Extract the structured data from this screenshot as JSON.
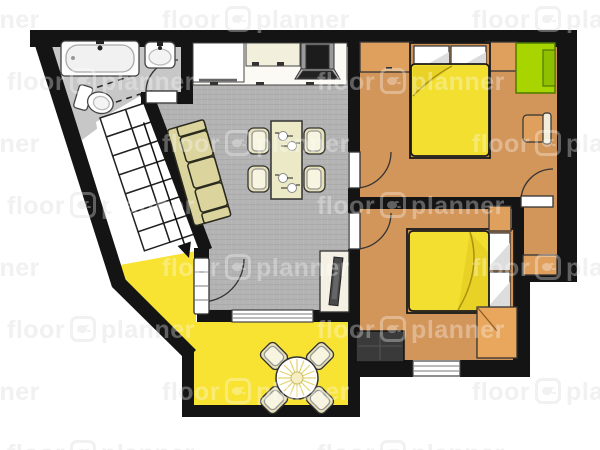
{
  "app": {
    "brand": "floorplanner"
  },
  "watermark": {
    "word_left": "floor",
    "word_right": "planner",
    "logo": "floorplanner-paw-logo",
    "rows": 8,
    "tiles_per_row": 3,
    "row_spacing_px": 62,
    "tile_period_px": 310,
    "even_row_offset_px": -148,
    "odd_row_offset_px": 7,
    "first_row_top_px": 6
  },
  "palette": {
    "wall": "#141414",
    "outline": "#222222",
    "bath_floor": "#c7c7c7",
    "living_floor": "#b3b3b3",
    "bedroom_floor": "#d2955a",
    "cabinet": "#dfa05e",
    "cabinet_light": "#e8a75d",
    "desk_green": "#a8d400",
    "desk_green_dark": "#8fc000",
    "yellow_floor": "#f8e232",
    "bed_yellow": "#f2df30",
    "bed_fold": "#e9d226",
    "sofa": "#dbd49c",
    "chair": "#e7e1b8",
    "table": "#ece9c6",
    "white": "#ffffff",
    "dresser_dark": "#3a3a3a",
    "stove_gray": "#9a9a9a",
    "watermark": "#ebebeb",
    "watermark_overlay": "#ffffff"
  },
  "floorplan": {
    "rooms": [
      {
        "name": "bathroom",
        "floor_color_key": "bath_floor"
      },
      {
        "name": "living-kitchen-dining",
        "floor_color_key": "living_floor"
      },
      {
        "name": "bedroom-1",
        "floor_color_key": "bedroom_floor"
      },
      {
        "name": "bedroom-2",
        "floor_color_key": "bedroom_floor"
      },
      {
        "name": "closet-alcove",
        "floor_color_key": "bedroom_floor"
      },
      {
        "name": "sun-room-dining-nook",
        "floor_color_key": "yellow_floor"
      },
      {
        "name": "staircase-area",
        "floor_color_key": "white"
      }
    ],
    "furniture": [
      "bathtub",
      "bathroom-sink",
      "toilet",
      "kitchen-counter",
      "fridge",
      "stove",
      "dining-table",
      "dining-chairs",
      "sofa",
      "stairs",
      "tv-sideboard",
      "double-bed-1",
      "double-bed-2",
      "wardrobe-cabinets",
      "green-desk",
      "side-chair",
      "nightstand",
      "corner-cabinet",
      "dark-dresser",
      "round-table",
      "round-table-chairs",
      "alcove-cabinet"
    ]
  }
}
